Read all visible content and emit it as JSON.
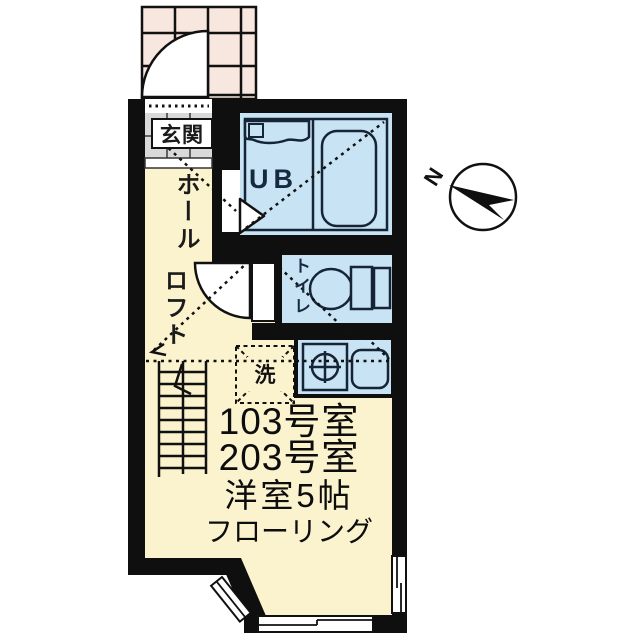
{
  "labels": {
    "entrance": "玄関",
    "hall": "ホール",
    "loft": "ロフト",
    "unit_bath": "UB",
    "toilet": "トイレ",
    "washer": "洗",
    "north": "N"
  },
  "room_info": {
    "line1": "103号室",
    "line2": "203号室",
    "line3": "洋室5帖",
    "line4": "フローリング"
  },
  "colors": {
    "floor_yellow": "#fbf3cd",
    "wet_area_blue": "#c8e3f3",
    "porch_tile_pink": "#f7e7de",
    "genkan_tile_gray": "#d9d9d9",
    "wall_black": "#0f0f0f",
    "fixture_stroke": "#152536"
  }
}
